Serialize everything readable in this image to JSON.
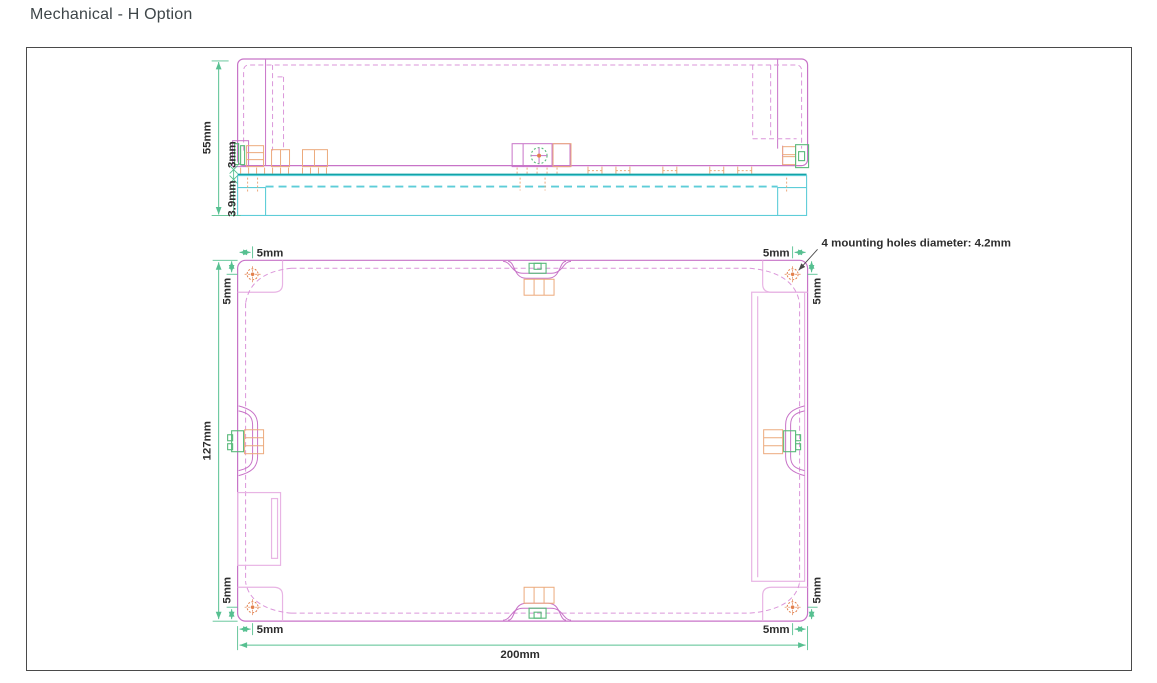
{
  "page": {
    "title": "Mechanical - H Option"
  },
  "drawing": {
    "annotation": "4 mounting holes diameter: 4.2mm",
    "dims": {
      "side_height": "55mm",
      "pcb_gap": "3mm",
      "base_thickness": "3.9mm",
      "hole_inset": "5mm",
      "overall_depth": "127mm",
      "overall_width": "200mm"
    },
    "colors": {
      "outline_magenta": "#c873c8",
      "dashed_magenta": "#db96da",
      "light_pink": "#e8b4e4",
      "dimension_green": "#57c091",
      "cyan_base": "#5ecdd8",
      "teal_pcb": "#12a3a6",
      "orange_detail": "#ecaa7c",
      "hole_orange": "#e2814e",
      "connector_green": "#58b97a",
      "text": "#2d2d2d",
      "frame_border": "#4a4a4a"
    }
  }
}
